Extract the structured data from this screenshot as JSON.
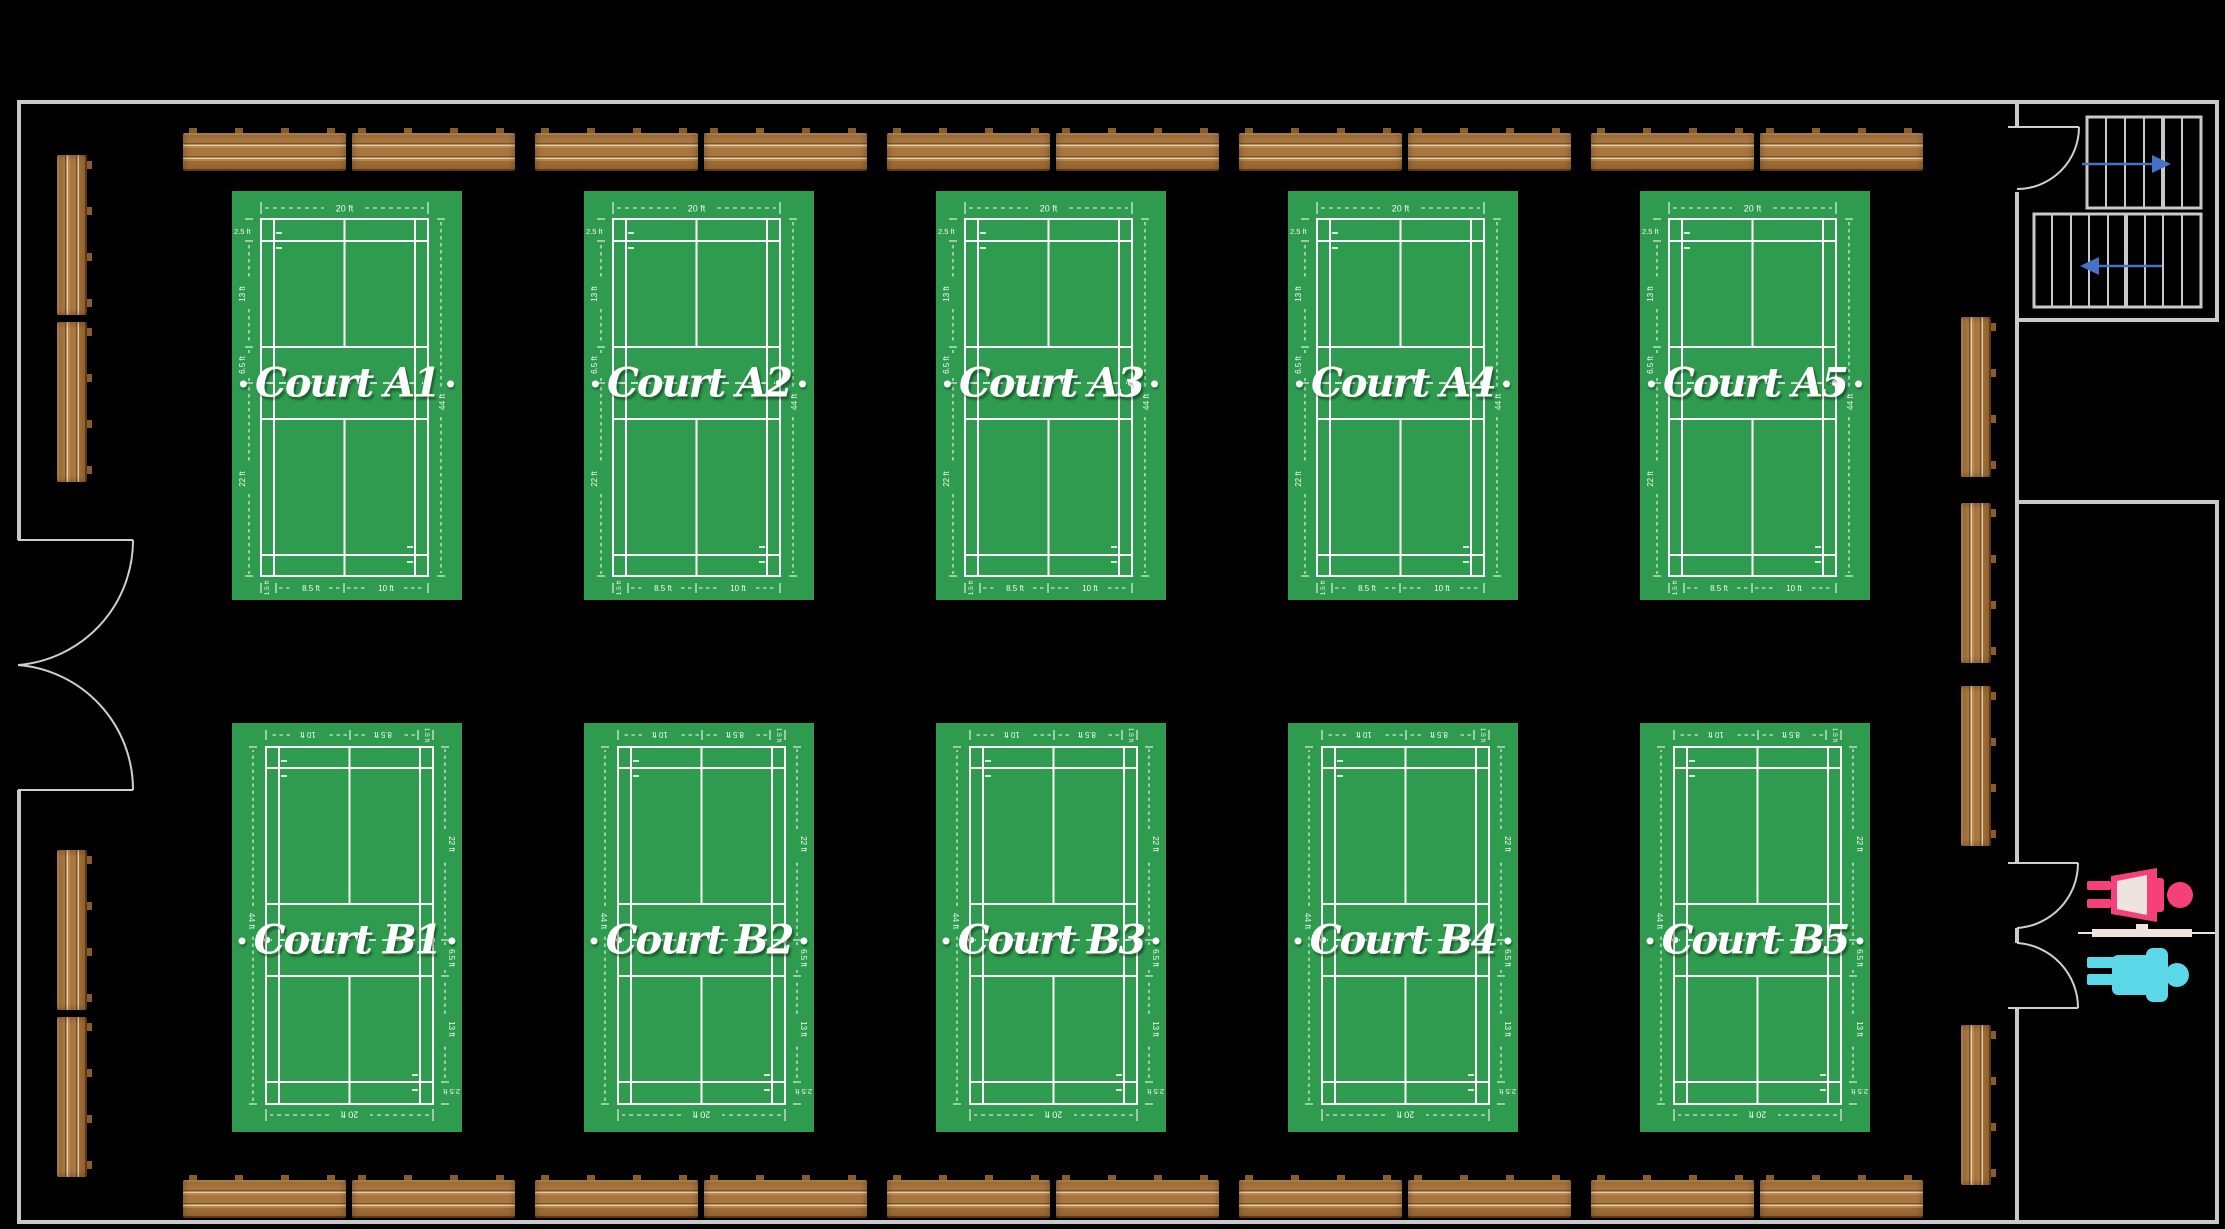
{
  "facility": {
    "name": "badminton-courts-floorplan",
    "court_rows": [
      "A",
      "B"
    ],
    "courts_per_row": 5
  },
  "courts": [
    {
      "id": "A1",
      "label": "Court A1",
      "row": "A"
    },
    {
      "id": "A2",
      "label": "Court A2",
      "row": "A"
    },
    {
      "id": "A3",
      "label": "Court A3",
      "row": "A"
    },
    {
      "id": "A4",
      "label": "Court A4",
      "row": "A"
    },
    {
      "id": "A5",
      "label": "Court A5",
      "row": "A"
    },
    {
      "id": "B1",
      "label": "Court B1",
      "row": "B"
    },
    {
      "id": "B2",
      "label": "Court B2",
      "row": "B"
    },
    {
      "id": "B3",
      "label": "Court B3",
      "row": "B"
    },
    {
      "id": "B4",
      "label": "Court B4",
      "row": "B"
    },
    {
      "id": "B5",
      "label": "Court B5",
      "row": "B"
    }
  ],
  "court_annotations": {
    "top_width": "20 ft",
    "left": [
      "2.5 ft",
      "13 ft",
      "6.5 ft",
      "22 ft"
    ],
    "right_height": "44 ft",
    "bottom": [
      "1.5 ft",
      "8.5 ft",
      "10 ft"
    ]
  },
  "decor": {
    "net_dot": "•"
  },
  "annex": {
    "stairs_upper_flight_steps": 6,
    "stairs_lower_flight_steps": 9,
    "stairs_up_arrow_direction": "right",
    "stairs_down_arrow_direction": "left"
  },
  "colors": {
    "background": "#000000",
    "wall_gray": "#c9c9c9",
    "door_gray": "#cfcfcf",
    "court_green": "#2f9b4e",
    "court_line_white": "#ffffff",
    "stairs_arrow_blue": "#4472c4",
    "female_pink": "#f5407c",
    "male_cyan": "#5ad8e8",
    "restroom_beige": "#efe3dd",
    "bench_wood": "#a9763f"
  }
}
